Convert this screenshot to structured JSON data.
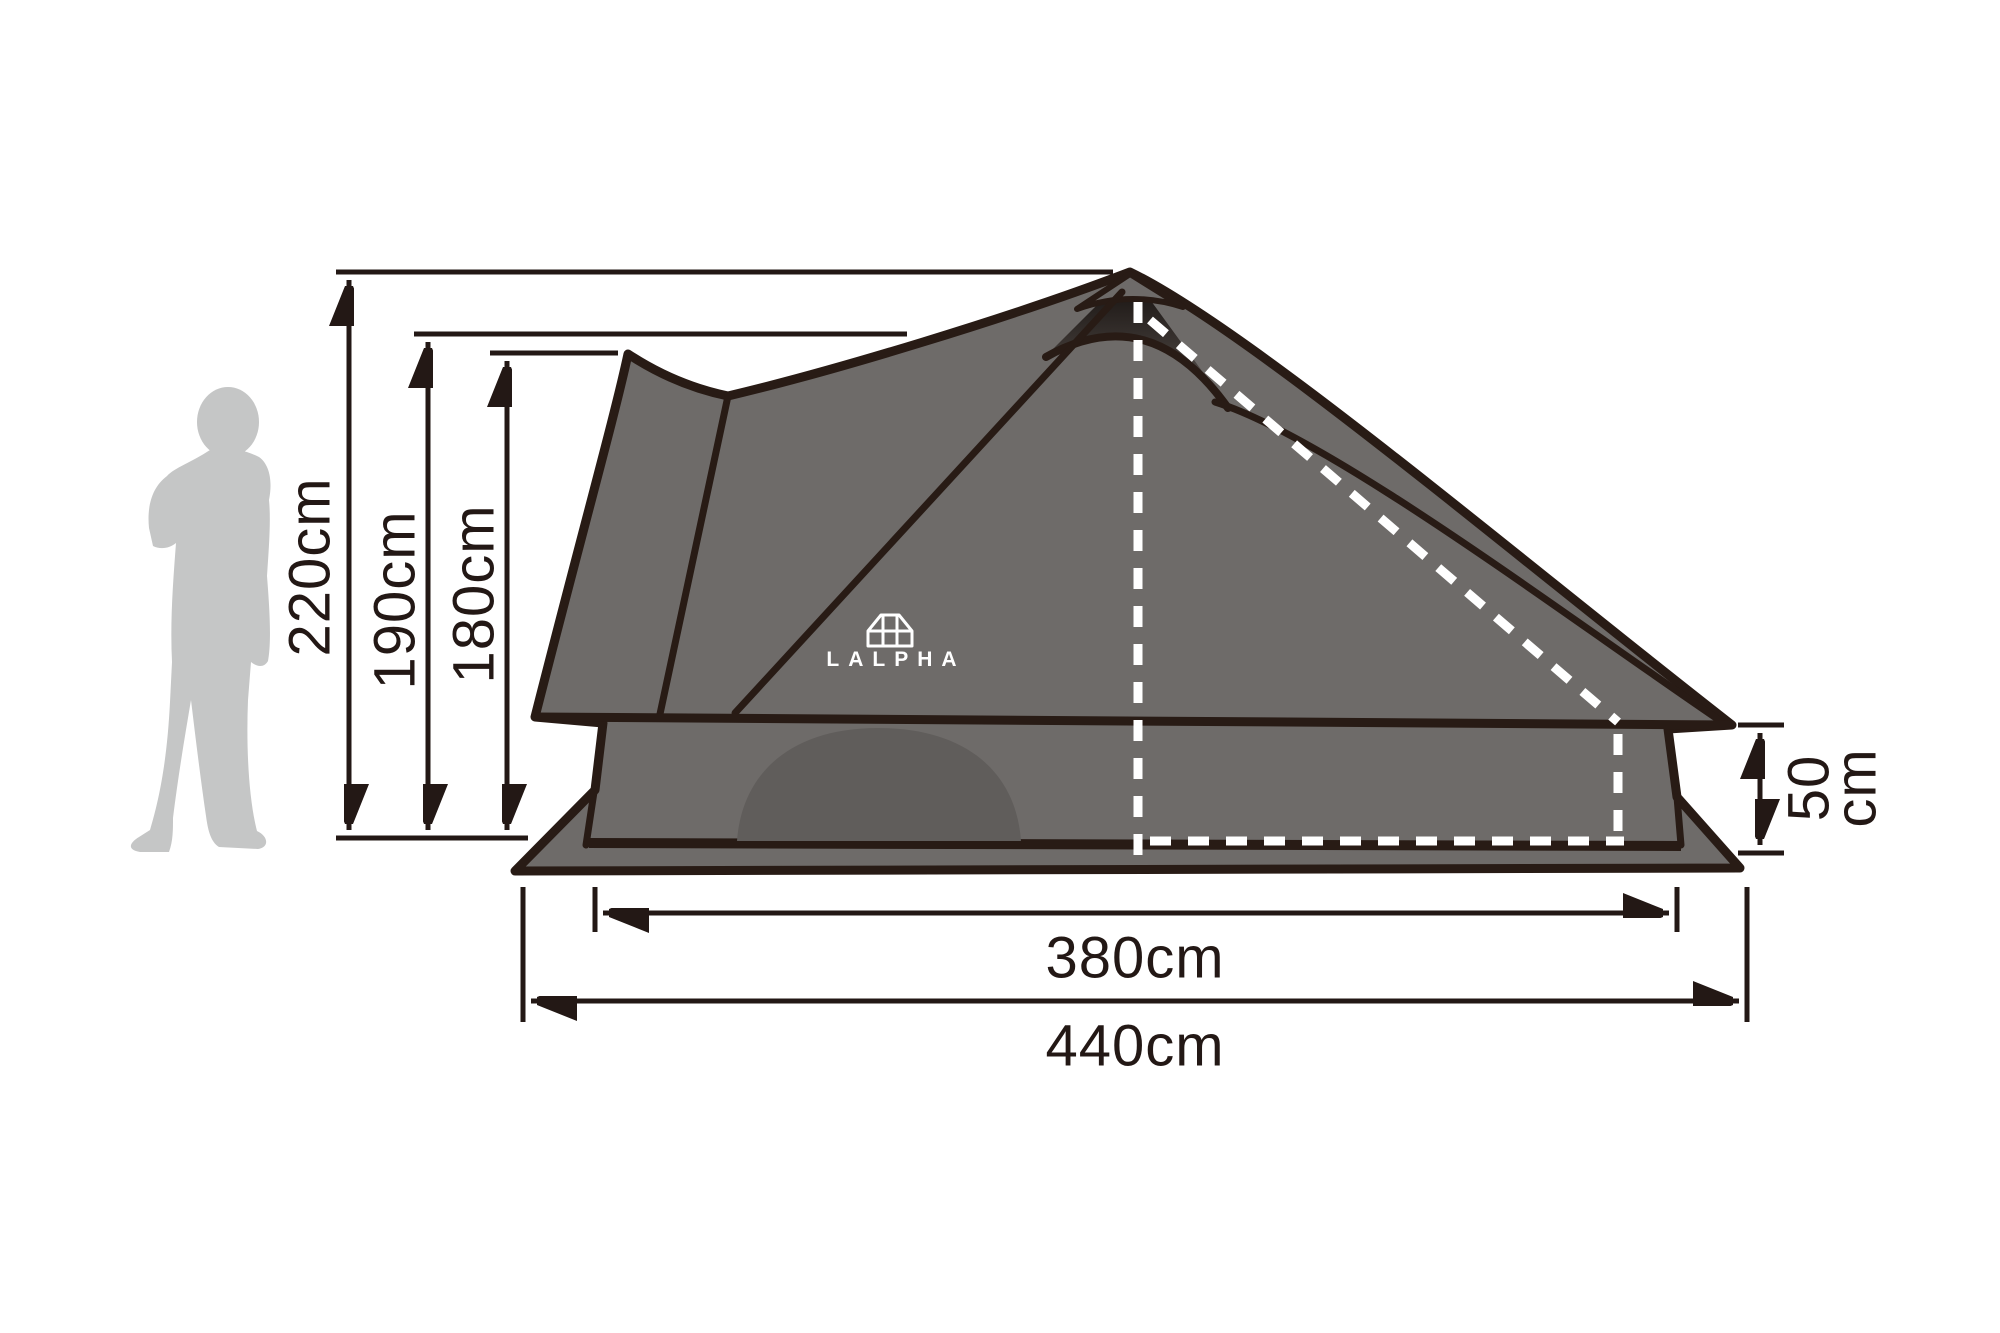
{
  "diagram": {
    "type": "tent-dimension-diagram",
    "brand": {
      "logo_text": "LALPHA",
      "logo_icon": "tent-icon"
    },
    "dimensions": {
      "height_total": "220cm",
      "height_ridge": "190cm",
      "height_back": "180cm",
      "width_inner": "380cm",
      "width_total": "440cm",
      "skirt_value": "50",
      "skirt_unit": "cm"
    },
    "colors": {
      "tent_body": "#6e6b69",
      "tent_door": "#605d5b",
      "tent_outline": "#281b15",
      "dimension_ink": "#231815",
      "human_silhouette": "#c5c6c6",
      "dashed_guides": "#ffffff",
      "background": "#ffffff"
    }
  }
}
